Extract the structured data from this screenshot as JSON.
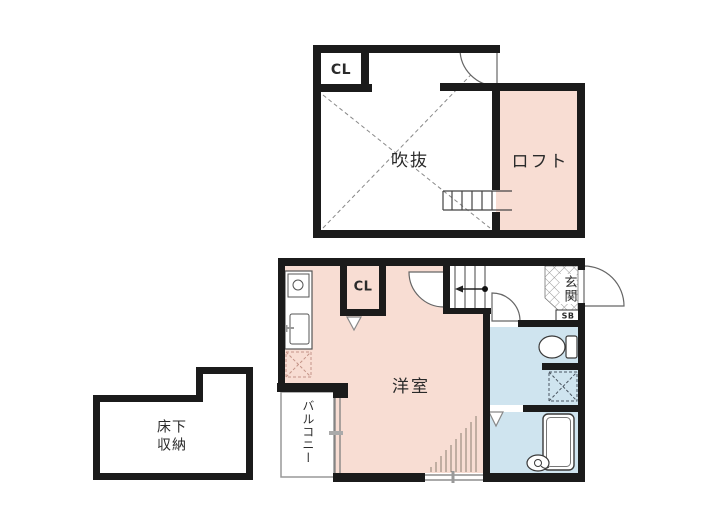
{
  "plan": {
    "type": "floor-plan",
    "colors": {
      "wall": "#1b1b1b",
      "room_pink": "#f8ddd3",
      "room_blue": "#cfe4ef",
      "outline": "#555555"
    },
    "upper_floor": {
      "closet_label": "CL",
      "atrium_label": "吹抜",
      "loft_label": "ロフト"
    },
    "lower_floor": {
      "closet_label": "CL",
      "main_room_label": "洋室",
      "entrance_label": "玄関",
      "shoe_box_label": "SB",
      "balcony_label": "バルコニー",
      "storage_label_lines": [
        "床下",
        "収納"
      ]
    }
  }
}
